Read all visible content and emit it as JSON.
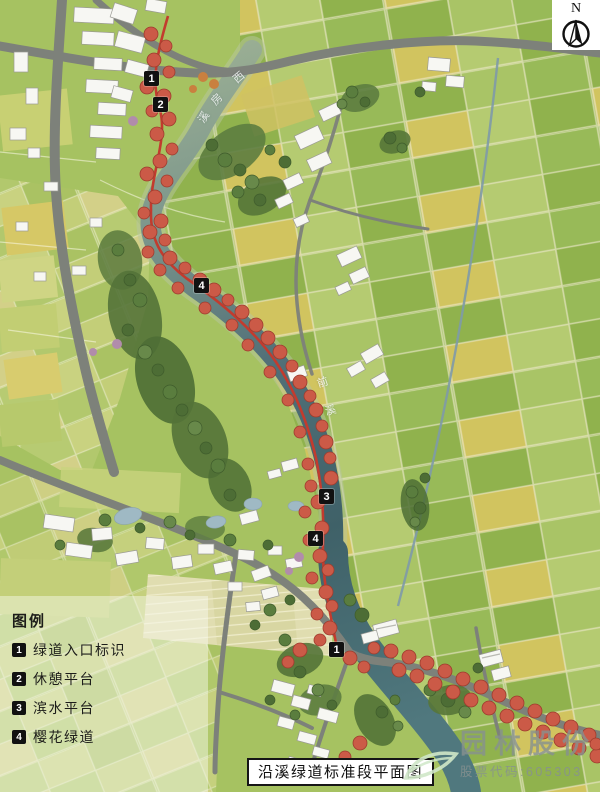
{
  "north": {
    "label": "N"
  },
  "legend": {
    "heading": "图例",
    "items": [
      {
        "num": "1",
        "label": "绿道入口标识"
      },
      {
        "num": "2",
        "label": "休憩平台"
      },
      {
        "num": "3",
        "label": "滨水平台"
      },
      {
        "num": "4",
        "label": "樱花绿道"
      }
    ]
  },
  "markers": [
    "1",
    "2",
    "4",
    "3",
    "4",
    "1"
  ],
  "river_labels": {
    "upper": [
      "西",
      "房",
      "溪"
    ],
    "lower": [
      "前",
      "溪"
    ]
  },
  "title_bar": {
    "text": "沿溪绿道标准段平面图"
  },
  "watermark": {
    "brand": "园林股份",
    "stock_code": "股票代码:605303"
  },
  "colors": {
    "greenway_path": "#c23b2e",
    "cherry_tree": "#cb5a47",
    "river_deep": "#3f6168",
    "river_upper": "#9cb094",
    "field_green": "#9dbc57",
    "field_yellow": "#d3c45f",
    "road_gray": "#7d817a",
    "marker_bg": "#111111"
  }
}
